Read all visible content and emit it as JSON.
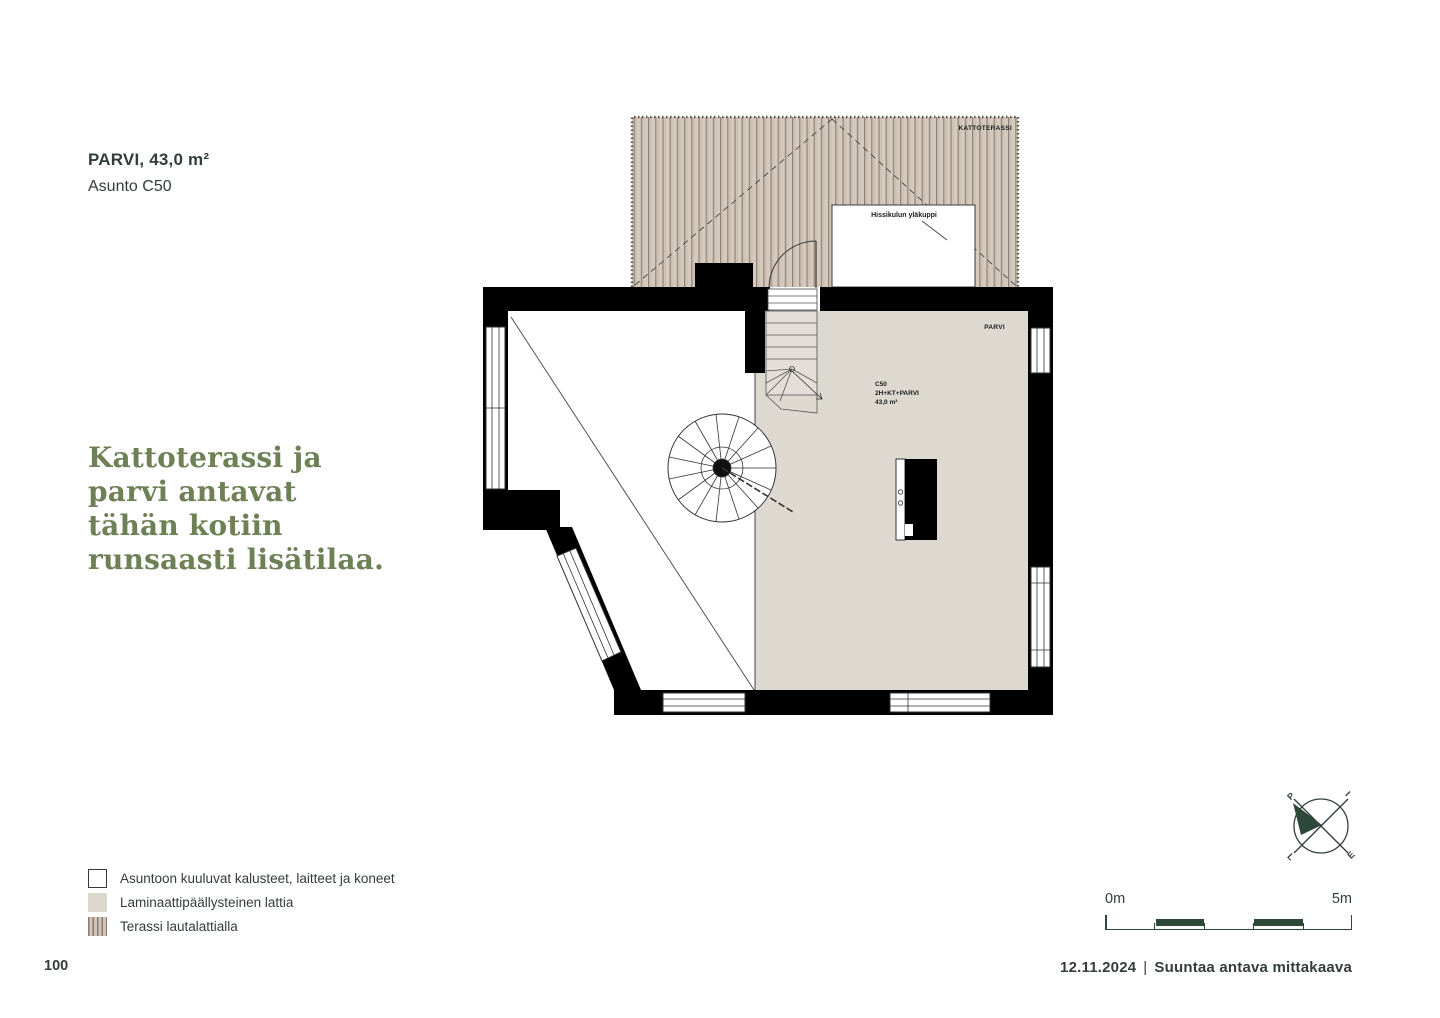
{
  "header": {
    "title": "PARVI, 43,0 m²",
    "subtitle": "Asunto C50"
  },
  "headline": {
    "lines": [
      "Kattoterassi ja",
      "parvi antavat",
      "tähän kotiin",
      "runsaasti lisätilaa."
    ]
  },
  "plan": {
    "labels": {
      "roof_terrace": "KATTOTERASSI",
      "elevator_top": "Hissikulun yläkuppi",
      "loft": "PARVI",
      "apartment_id": "C50",
      "apartment_type": "2H+KT+PARVI",
      "apartment_area": "43,0 m²"
    }
  },
  "legend": {
    "items": [
      {
        "swatch": "furniture-white-box",
        "label": "Asuntoon kuuluvat kalusteet, laitteet ja koneet"
      },
      {
        "swatch": "laminate-beige",
        "label": "Laminaattipäällysteinen lattia"
      },
      {
        "swatch": "terrace-stripes",
        "label": "Terassi lautalattialla"
      }
    ]
  },
  "compass": {
    "letters": [
      "P",
      "I",
      "E",
      "L"
    ]
  },
  "scalebar": {
    "start_label": "0m",
    "end_label": "5m"
  },
  "footer": {
    "page_number": "100",
    "date": "12.11.2024",
    "separator": "|",
    "note": "Suuntaa antava mittakaava"
  },
  "colors": {
    "text_dark": "#333e39",
    "headline_green": "#6e8055",
    "scale_green": "#2d4839",
    "terrace_deck": "#d5cabe",
    "laminate_floor": "#ddd9d1",
    "wall_black": "#000000"
  }
}
